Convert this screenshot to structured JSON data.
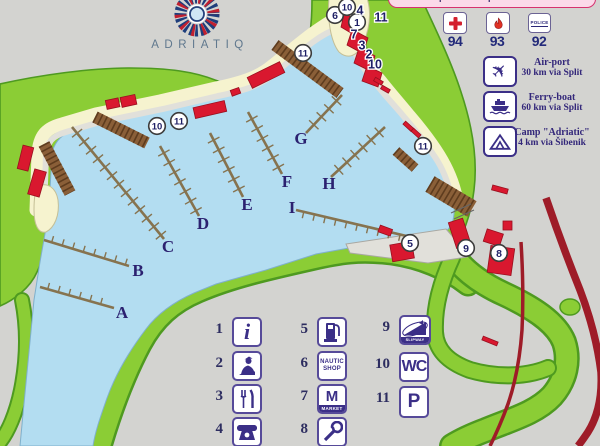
{
  "brand": {
    "name": "ADRIATIQ"
  },
  "banner": {
    "text": "Important telephone numbers"
  },
  "phones": {
    "police_label": "POLICE",
    "items": [
      {
        "icon": "red-cross-icon",
        "number": "94"
      },
      {
        "icon": "fire-icon",
        "number": "93"
      },
      {
        "icon": "police-icon",
        "number": "92"
      }
    ]
  },
  "services": {
    "items": [
      {
        "name": "airport",
        "line1": "Air-port",
        "line2": "30 km via Split"
      },
      {
        "name": "ferry",
        "line1": "Ferry-boat",
        "line2": "60 km via Split"
      },
      {
        "name": "camp",
        "line1": "Camp \"Adriatic\"",
        "line2": "4 km via Šibenik"
      }
    ]
  },
  "legend": {
    "items": [
      {
        "num": "1",
        "icon": "info-icon"
      },
      {
        "num": "2",
        "icon": "customs-icon"
      },
      {
        "num": "3",
        "icon": "restaurant-icon"
      },
      {
        "num": "4",
        "icon": "telephone-icon"
      },
      {
        "num": "5",
        "icon": "fuel-icon"
      },
      {
        "num": "6",
        "icon": "nautic-shop-icon",
        "lines": [
          "NAUTIC",
          "SHOP"
        ]
      },
      {
        "num": "7",
        "icon": "market-icon",
        "letter": "M",
        "label": "MARKET"
      },
      {
        "num": "8",
        "icon": "service-icon"
      },
      {
        "num": "9",
        "icon": "slipway-icon",
        "label": "SLIPWAY"
      },
      {
        "num": "10",
        "icon": "wc-icon",
        "label": "WC"
      },
      {
        "num": "11",
        "icon": "parking-icon",
        "label": "P"
      }
    ]
  },
  "map": {
    "colors": {
      "water": "#b3ddf1",
      "land": "#8bcd35",
      "land_edge": "#4e9a20",
      "beach": "#f6f3cf",
      "quay": "#e1e0da",
      "dock": "#8a5f38",
      "pier": "#86734f",
      "building": "#d9182f",
      "road": "#9e1c28",
      "navy": "#2b2170",
      "marker_ring": "#3c3c3c"
    },
    "pier_labels": [
      {
        "label": "A",
        "x": 122,
        "y": 312
      },
      {
        "label": "B",
        "x": 138,
        "y": 270
      },
      {
        "label": "C",
        "x": 168,
        "y": 246
      },
      {
        "label": "D",
        "x": 203,
        "y": 223
      },
      {
        "label": "E",
        "x": 247,
        "y": 204
      },
      {
        "label": "F",
        "x": 287,
        "y": 181
      },
      {
        "label": "G",
        "x": 301,
        "y": 138
      },
      {
        "label": "H",
        "x": 329,
        "y": 183
      },
      {
        "label": "I",
        "x": 292,
        "y": 207
      }
    ],
    "piers": [
      {
        "x1": 40,
        "y1": 287,
        "x2": 114,
        "y2": 308,
        "side": 1
      },
      {
        "x1": 44,
        "y1": 240,
        "x2": 129,
        "y2": 266,
        "side": 1
      },
      {
        "x1": 72,
        "y1": 127,
        "x2": 164,
        "y2": 239,
        "side": 0
      },
      {
        "x1": 160,
        "y1": 146,
        "x2": 199,
        "y2": 216,
        "side": 0
      },
      {
        "x1": 210,
        "y1": 133,
        "x2": 243,
        "y2": 197,
        "side": 0
      },
      {
        "x1": 248,
        "y1": 112,
        "x2": 282,
        "y2": 174,
        "side": 0
      },
      {
        "x1": 342,
        "y1": 95,
        "x2": 306,
        "y2": 133,
        "side": 0
      },
      {
        "x1": 385,
        "y1": 127,
        "x2": 331,
        "y2": 177,
        "side": 0
      },
      {
        "x1": 296,
        "y1": 210,
        "x2": 415,
        "y2": 238,
        "side": -1
      }
    ],
    "markers": [
      {
        "t": "10",
        "x": 157,
        "y": 126,
        "c": 1
      },
      {
        "t": "11",
        "x": 179,
        "y": 121,
        "c": 1
      },
      {
        "t": "11",
        "x": 303,
        "y": 53,
        "c": 1
      },
      {
        "t": "6",
        "x": 335,
        "y": 15,
        "c": 1
      },
      {
        "t": "10",
        "x": 347,
        "y": 7,
        "c": 1
      },
      {
        "t": "1",
        "x": 357,
        "y": 22,
        "c": 1
      },
      {
        "t": "4",
        "x": 360,
        "y": 10,
        "c": 0
      },
      {
        "t": "11",
        "x": 381,
        "y": 17,
        "c": 0
      },
      {
        "t": "7",
        "x": 354,
        "y": 34,
        "c": 0
      },
      {
        "t": "3",
        "x": 362,
        "y": 45,
        "c": 0
      },
      {
        "t": "2",
        "x": 369,
        "y": 54,
        "c": 0
      },
      {
        "t": "10",
        "x": 375,
        "y": 64,
        "c": 0
      },
      {
        "t": "11",
        "x": 423,
        "y": 146,
        "c": 1
      },
      {
        "t": "5",
        "x": 410,
        "y": 243,
        "c": 1
      },
      {
        "t": "9",
        "x": 466,
        "y": 248,
        "c": 1
      },
      {
        "t": "8",
        "x": 499,
        "y": 253,
        "c": 1
      }
    ]
  }
}
